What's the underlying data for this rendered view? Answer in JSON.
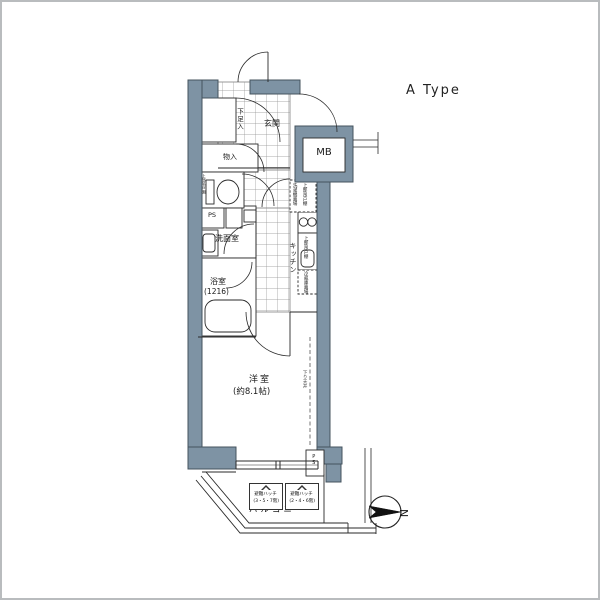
{
  "page": {
    "plan_type_label": "A Type"
  },
  "floorplan": {
    "labels": {
      "entrance": "玄関",
      "shoe_cabinet": "下足入",
      "storage": "物入",
      "toilet_upper_shelf": "上部吊戸棚",
      "pipe_space": "PS",
      "washroom": "洗面室",
      "bathroom": "浴室",
      "bathroom_size": "(1216)",
      "kitchen": "キッチン",
      "laundry_space": "洗濯機置場",
      "laundry_upper_cabinet": "上部吊戸棚",
      "sink_upper_cabinet": "上部吊戸棚",
      "fridge_space": "冷蔵庫置場",
      "western_room": "洋室",
      "western_room_size": "(約8.1帖)",
      "dropped_ceiling": "下り天井",
      "meter_box": "MB",
      "pipe_space_2": "PS",
      "balcony": "バルコニー",
      "hatch_a_line1": "避難ハッチ",
      "hatch_a_line2": "(3・5・7階)",
      "hatch_b_line1": "避難ハッチ",
      "hatch_b_line2": "(2・4・6階)",
      "compass_north": "N"
    },
    "colors": {
      "wall": "#7E93A4",
      "wall_outline": "#44535E",
      "line": "#2a2a2a",
      "grid": "#909090"
    }
  }
}
